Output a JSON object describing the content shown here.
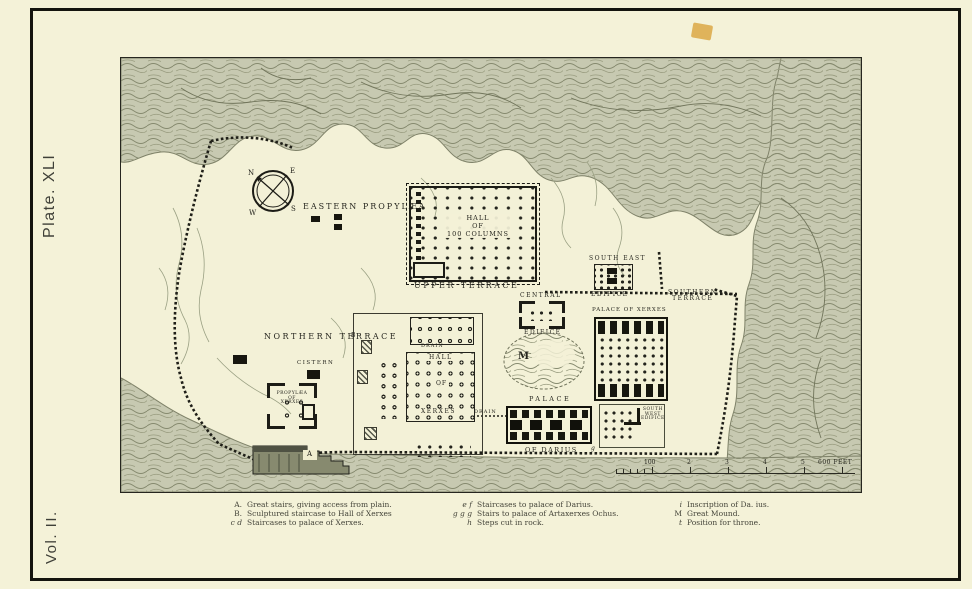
{
  "colors": {
    "paper": "#f4f2d8",
    "map_paper": "#f3f1d7",
    "terrain": "#c7c9b1",
    "ink": "#1c1c16",
    "blemish": "#d9a23c"
  },
  "page": {
    "plate_label": "Plate. XLI",
    "volume_label": "Vol. II."
  },
  "compass": {
    "n": "N",
    "e": "E",
    "s": "S",
    "w": "W"
  },
  "map": {
    "labels": {
      "eastern_propylaea": "EASTERN PROPYLÆA",
      "hall_100": [
        "HALL",
        "OF",
        "100 COLUMNS"
      ],
      "upper_terrace": "UPPER TERRACE",
      "northern_terrace": "NORTHERN TERRACE",
      "cistern": "CISTERN",
      "propylaea_xerxes": [
        "PROPYLÆA",
        "OF",
        "XERXES"
      ],
      "hall_xerxes": [
        "HALL",
        "OF",
        "XERXES"
      ],
      "drain_north": "DRAIN",
      "drain_south": "DRAIN",
      "central_edifice": [
        "CENTRAL",
        "EDIFICE"
      ],
      "south_east_edifice": [
        "SOUTH EAST",
        "EDIFICE"
      ],
      "southern_terrace": [
        "SOUTHERN",
        "TERRACE"
      ],
      "palace_of_xerxes": "PALACE OF XERXES",
      "south_west_edifice": [
        "SOUTH",
        "WEST",
        "EDIFICE"
      ],
      "palace_darius": [
        "PALACE",
        "OF DARIUS"
      ],
      "mound": "M",
      "stairs_a": "A",
      "stairs_b": "B",
      "stairs_g": "g"
    },
    "scale": {
      "ticks": [
        "100",
        "2",
        "3",
        "4",
        "5"
      ],
      "end": "600 FEET"
    }
  },
  "legend": {
    "col1": [
      {
        "key": "A.",
        "text": "Great stairs, giving access from plain."
      },
      {
        "key": "B.",
        "text": "Sculptured staircase to Hall of Xerxes"
      },
      {
        "key": "c d",
        "text": "Staircases to palace of Xerxes."
      }
    ],
    "col2": [
      {
        "key": "e f",
        "text": "Staircases to palace of Darius."
      },
      {
        "key": "g g g",
        "text": "Stairs to palace of Artaxerxes Ochus."
      },
      {
        "key": "h",
        "text": "Steps cut in rock."
      }
    ],
    "col3": [
      {
        "key": "i",
        "text": "Inscription of Da. ius."
      },
      {
        "key": "M",
        "text": "Great Mound."
      },
      {
        "key": "t",
        "text": "Position for throne."
      }
    ]
  }
}
